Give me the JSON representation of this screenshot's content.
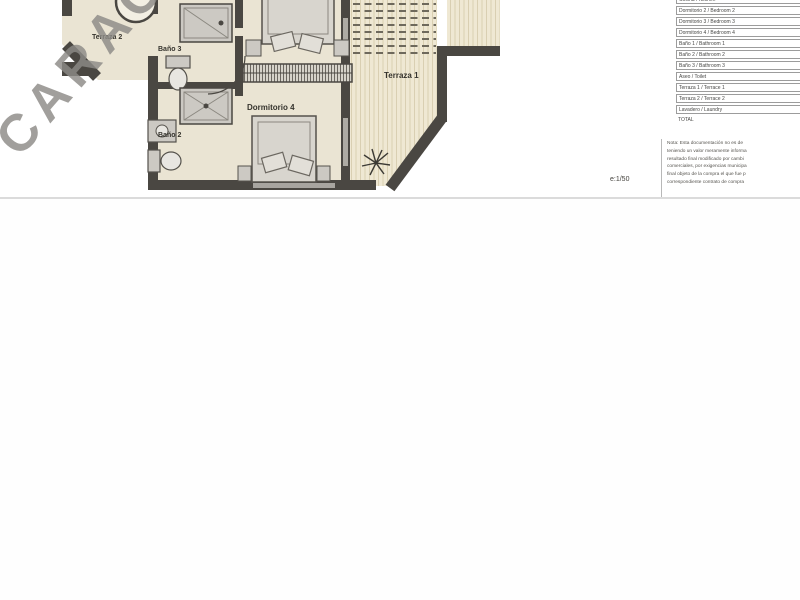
{
  "watermark": {
    "text": "CARAC"
  },
  "plan": {
    "scale_label": "e:1/50",
    "rooms": {
      "terraza1": "Terraza 1",
      "terraza2": "Terraza 2",
      "dormitorio4": "Dormitorio 4",
      "bano3": "Baño 3",
      "bano2": "Baño 2"
    },
    "colors": {
      "walls": "#4a4742",
      "floor": "#eae4d3",
      "deck": "#efe8d3",
      "deck_stripe": "#d9cfb2",
      "fixture": "#ccc9c3"
    }
  },
  "legend_table": {
    "rows": [
      "Cocina / Kitchen",
      "Dormitorio 2 / Bedroom 2",
      "Dormitorio 3 / Bedroom 3",
      "Dormitorio 4 / Bedroom 4",
      "Baño 1 / Bathroom 1",
      "Baño 2 / Bathroom 2",
      "Baño 3 / Bathroom 3",
      "Aseo / Toilet",
      "Terraza 1 / Terrace 1",
      "Terraza 2 / Terrace 2",
      "Lavadero / Laundry",
      "TOTAL"
    ]
  },
  "notes": {
    "lines": [
      "Nota: Esta documentación no es de",
      "teniendo un valor meramente informa",
      "resultado final modificado por cambi",
      "comerciales, por exigencias municipa",
      "final objeto de la compra el que fue p",
      "correspondiente contrato de compra"
    ]
  }
}
